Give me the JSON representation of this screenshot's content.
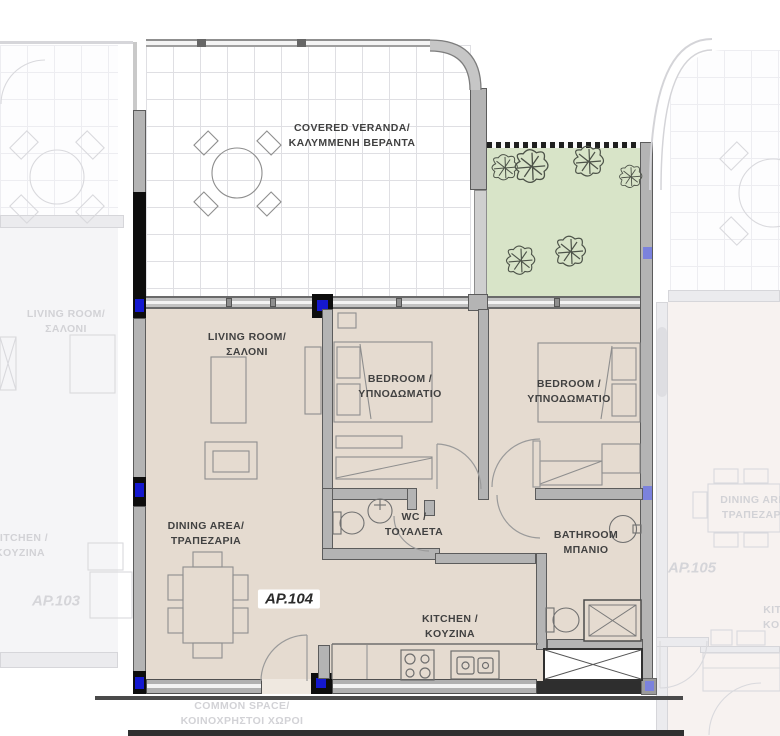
{
  "plan": {
    "unit": {
      "id": "AP.104"
    },
    "rooms": {
      "veranda": {
        "en": "COVERED VERANDA/",
        "gr": "ΚΑΛΥΜΜΕΝΗ ΒΕΡΑΝΤΑ"
      },
      "living": {
        "en": "LIVING ROOM/",
        "gr": "ΣΑΛΟΝΙ"
      },
      "bedroom1": {
        "en": "BEDROOM /",
        "gr": "ΥΠΝΟΔΩΜΑΤΙΟ"
      },
      "bedroom2": {
        "en": "BEDROOM /",
        "gr": "ΥΠΝΟΔΩΜΑΤΙΟ"
      },
      "wc": {
        "en": "WC /",
        "gr": "ΤΟΥΑΛΕΤΑ"
      },
      "bathroom": {
        "en": "BATHROOM",
        "gr": "ΜΠΑΝΙΟ"
      },
      "dining": {
        "en": "DINING AREA/",
        "gr": "ΤΡΑΠΕΖΑΡΙΑ"
      },
      "kitchen": {
        "en": "KITCHEN /",
        "gr": "KOYZINA"
      }
    },
    "neighbors": {
      "left": {
        "id": "AP.103",
        "living_en": "LIVING ROOM/",
        "living_gr": "ΣΑΛΟΝΙ",
        "kitchen_en": "KITCHEN /",
        "kitchen_gr": "KOYZINA"
      },
      "right": {
        "id": "AP.105",
        "dining_en": "DINING AREA",
        "dining_gr": "ΤΡΑΠΕΖΑΡΙΑ",
        "kitchen_en": "KITCHEN",
        "kitchen_gr": "KOYZINA"
      }
    },
    "common": {
      "en": "COMMON SPACE/",
      "gr": "ΚΟΙΝΟΧΡΗΣΤΟΙ ΧΩΡΟΙ"
    },
    "colors": {
      "floor": "#e5dbd0",
      "garden_green": "#d8e4c8",
      "wall_gray": "#b4b4b4",
      "wall_black": "#0d0d0d",
      "column_blue": "#1418cf",
      "faded_line": "#d9d9dd"
    }
  }
}
